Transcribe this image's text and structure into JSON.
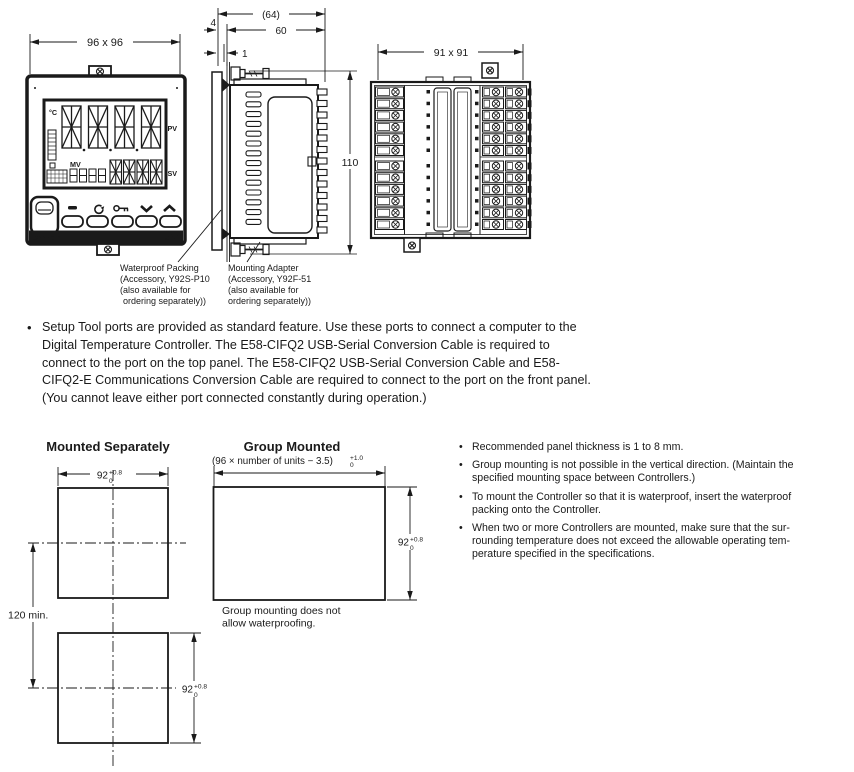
{
  "ui": {
    "bullet_char": "•"
  },
  "views": {
    "front": {
      "dim": "96 x 96",
      "unit": "°C",
      "pv": "PV",
      "mv": "MV",
      "sv": "SV",
      "brand": "omron",
      "model": "E5AC",
      "button_icons": [
        "pf-key-icon",
        "mode-loop-icon",
        "level-key-icon",
        "down-arrow-icon",
        "up-arrow-icon"
      ]
    },
    "side": {
      "dim_total": "(64)",
      "dim_depth": "60",
      "dim_bezel": "4",
      "dim_clearance": "1",
      "dim_height": "110"
    },
    "back": {
      "dim": "91 x 91"
    }
  },
  "accessories": {
    "waterproof_packing": {
      "lines": [
        "Waterproof Packing",
        "(Accessory, Y92S-P10",
        "(also available for",
        "ordering separately))"
      ]
    },
    "mounting_adapter": {
      "lines": [
        "Mounting Adapter",
        "(Accessory, Y92F-51",
        "(also available for",
        "ordering separately))"
      ]
    }
  },
  "setup_note": {
    "lines": [
      "Setup Tool ports are provided as standard feature. Use these ports to connect a computer to the",
      "Digital Temperature Controller. The E58-CIFQ2 USB-Serial Conversion Cable is required to",
      "connect to the port on the top panel. The E58-CIFQ2 USB-Serial Conversion Cable and E58-",
      "CIFQ2-E Communications Conversion Cable are required to connect to the port on the front panel.",
      "(You cannot leave either port connected constantly during operation.)"
    ]
  },
  "mounting": {
    "separately_title": "Mounted Separately",
    "group_title": "Group Mounted",
    "group_formula": "(96 × number of units − 3.5)",
    "group_tol_sup": "+1.0",
    "group_tol_sub": "0",
    "cutout": "92",
    "cutout_sup": "+0.8",
    "cutout_sub": "0",
    "pitch": "120 min.",
    "group_note_lines": [
      "Group mounting does not",
      "allow waterproofing."
    ]
  },
  "panel_notes": [
    {
      "lines": [
        "Recommended panel thickness is 1 to 8 mm."
      ]
    },
    {
      "lines": [
        "Group mounting is not possible in the vertical direction. (Maintain the",
        "specified mounting space between Controllers.)"
      ]
    },
    {
      "lines": [
        "To mount the Controller so that it is waterproof, insert the waterproof",
        "packing onto the Controller."
      ]
    },
    {
      "lines": [
        "When two or more Controllers are mounted, make sure that the sur-",
        "rounding temperature does not exceed the allowable operating tem-",
        "perature specified in the specifications."
      ]
    }
  ],
  "colors": {
    "ink": "#1a1a1a",
    "paper": "#ffffff"
  }
}
